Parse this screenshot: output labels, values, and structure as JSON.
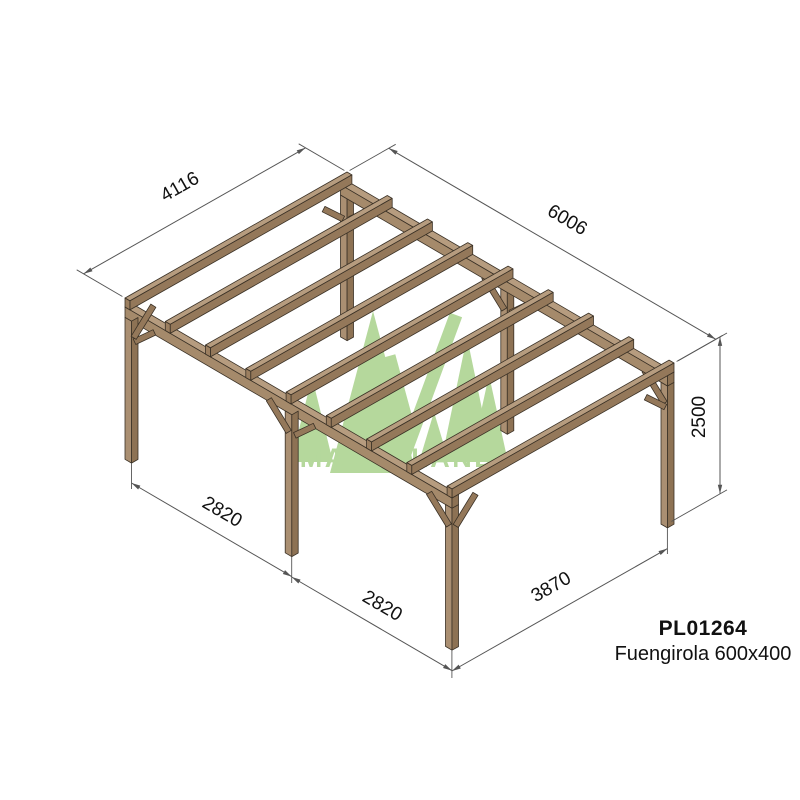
{
  "drawing": {
    "title": "Wooden pergola technical drawing",
    "brand_watermark": "MADERLAND",
    "product_code": "PL01264",
    "product_name": "Fuengirola 600x400",
    "dimension_labels": {
      "rafter_length": "4116",
      "total_length": "6006",
      "post_height": "2500",
      "front_span_1": "2820",
      "front_span_2": "2820",
      "side_span": "3870"
    },
    "colors": {
      "wood_top": "#b69c7f",
      "wood_side": "#94785a",
      "wood_light": "#aa8f72",
      "wood_mid": "#a58a6b",
      "wood_dark": "#8d7254",
      "wood_end": "#9c7f60",
      "outline": "#3a3126",
      "dimension_line": "#555555",
      "text": "#111111",
      "logo_green": "#b5d89c",
      "background": "#ffffff"
    }
  }
}
